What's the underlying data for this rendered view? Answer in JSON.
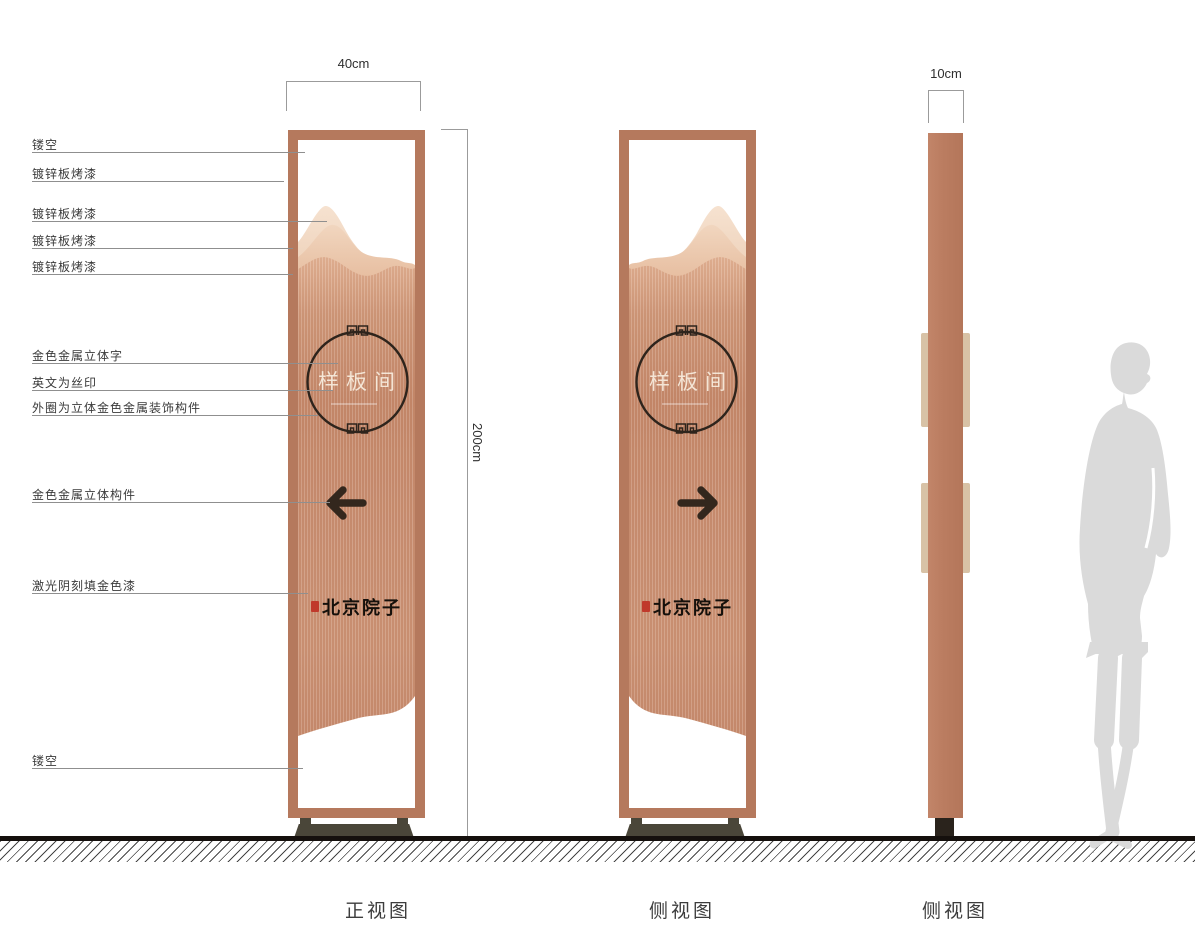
{
  "captions": [
    "正视图",
    "侧视图",
    "侧视图"
  ],
  "dimensions": {
    "width_label": "40cm",
    "height_label": "200cm",
    "depth_label": "10cm"
  },
  "callouts": [
    "镂空",
    "镀锌板烤漆",
    "镀锌板烤漆",
    "镀锌板烤漆",
    "镀锌板烤漆",
    "金色金属立体字",
    "英文为丝印",
    "外圈为立体金色金属装饰构件",
    "金色金属立体构件",
    "激光阴刻填金色漆",
    "镂空"
  ],
  "sign": {
    "room_name": "样板间",
    "calligraphy": "北京院子",
    "colors": {
      "frame_copper": "#b5795d",
      "panel_copper": "#c5886a",
      "panel_highlight": "#e2b193",
      "mountain_back": "#f6e2d0",
      "mountain_mid": "#f1d6bf",
      "ring_line": "#2e241c",
      "arrow": "#33271d",
      "base": "#4a4639",
      "side_tab": "#d8c2a6",
      "seal_red": "#c0392b",
      "ground": "#15100d",
      "silhouette": "#dadada"
    }
  }
}
